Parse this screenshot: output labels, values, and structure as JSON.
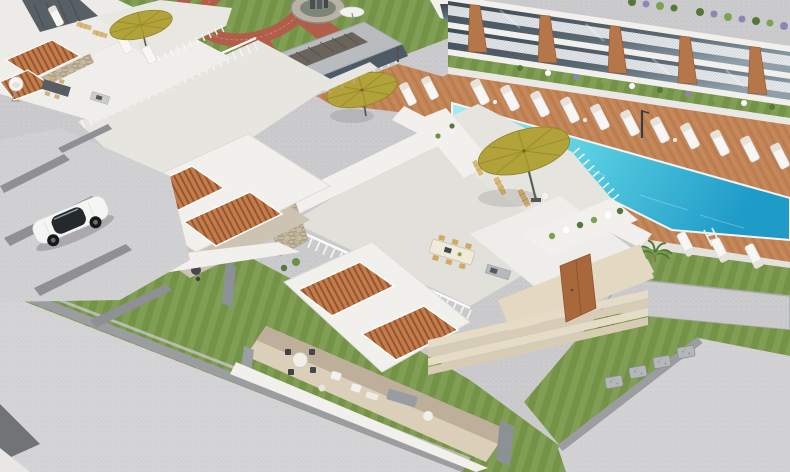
{
  "meta": {
    "width": 790,
    "height": 472,
    "domain": "Natural-Image",
    "description": "Aerial three-quarter 3D architectural visualization of a modern white villa and apartment resort complex in daylight: turquoise pool with timber deck and white sun loungers, olive cantilever parasols, flat-roof villas with orange timber pergola slats and rooftop terraces, landscaped garden with circular brick path and stone fountain, cobbled parking court with a white sports coupe, manicured lawns and light pebble pathways."
  },
  "scene": {
    "setting": "Aerial 3D render of a white modern villa resort with pool, gardens, lawns and parking",
    "areas": {
      "pool_terrace": [
        "long turquoise swimming pool",
        "timber sun deck",
        "white chaise loungers",
        "olive cantilever parasol",
        "pool ladder",
        "outdoor shower",
        "white curb edging"
      ],
      "apartment_block": [
        "two balcony levels",
        "white mesh railings",
        "floor-to-ceiling dark glazing",
        "tapered timber fins",
        "roof-edge planters with green and lavender planting",
        "ground-level planting strip"
      ],
      "garden_courtyard": [
        "circular terracotta brick path",
        "round stone fountain with dark sculpture",
        "white rattan pod chairs",
        "shrub planting",
        "palm trees",
        "white parasol"
      ],
      "bar_pavilion": [
        "flat grey roof with timber slat skylight",
        "shaded bar counter",
        "bar stools"
      ],
      "villas": [
        "white rendered walls",
        "rooftop terraces with picket railings",
        "orange timber pergola slats",
        "rooftop dining tables",
        "covered lounge terraces",
        "stone feature walls",
        "timber entrance door",
        "wide beige entrance steps",
        "roof planter ledges"
      ],
      "parking_court": [
        "light pebble paving",
        "dark cobblestone strips",
        "white sports coupe"
      ],
      "circulation": [
        "wide pebble roads with dark stone borders",
        "stepping-stone path across lawn",
        "lawn bands"
      ]
    },
    "object_counts": {
      "sun_loungers": 18,
      "olive_parasols": 3,
      "white_parasols": 1,
      "rattan_pod_chairs": 5,
      "timber_benches": 5,
      "palm_trees": 6,
      "villas_visible": 4,
      "apartment_buildings": 1,
      "swimming_pools": 1,
      "pool_ladders": 1,
      "fountains": 1,
      "cars": 1,
      "dining_sets": 3,
      "lounge_suites": 2,
      "stepping_stones": 4
    }
  },
  "palette": {
    "pebble": "#cbcbcd",
    "pebbleLight": "#d7d7d9",
    "pebbleDark": "#97989b",
    "lawn": "#79984a",
    "lawnDark": "#68873d",
    "deck": "#c28457",
    "deckDark": "#a56b40",
    "deckLight": "#d9a06c",
    "pool1": "#a7ecf2",
    "pool2": "#1f9bc8",
    "umbrella": "#b1a339",
    "umbrellaDark": "#958727",
    "white": "#f2f0ed",
    "whiteDim": "#e4e2dd",
    "shade": "#cfc8ba",
    "slat": "#c67c4a",
    "slatDark": "#8e5530",
    "timber": "#b5764a",
    "doorWood": "#a9683c",
    "glassDark": "#3e4a54",
    "glassLight": "#8fa0ab",
    "stone": "#c6baa2",
    "terracotta": "#b25d49",
    "plant": "#55783a",
    "plantLight": "#7fa251",
    "lavender": "#8d86b4",
    "floorBeige": "#dbcfba",
    "stepBeige": "#e3d8c2",
    "furnGray": "#989da1",
    "darkFrame": "#43484d"
  }
}
